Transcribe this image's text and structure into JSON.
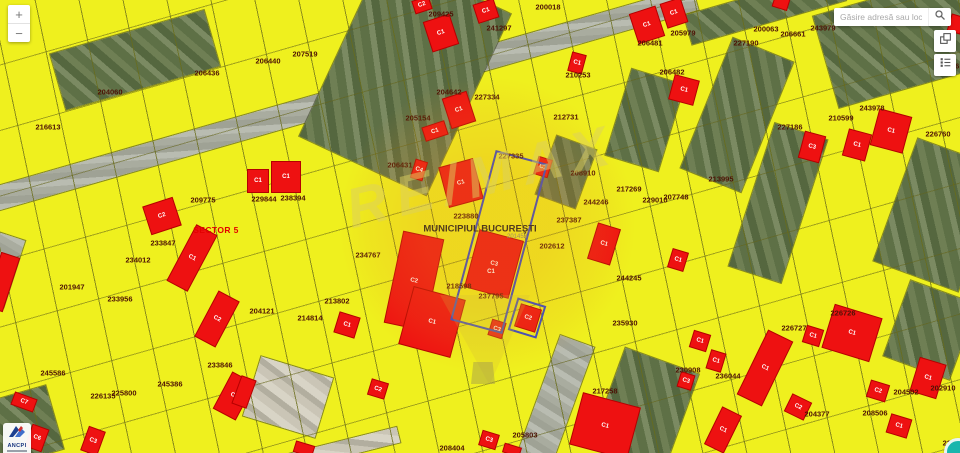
{
  "controls": {
    "zoom_in": "+",
    "zoom_out": "−",
    "search_placeholder": "Găsire adresă sau loc",
    "icons": {
      "search": "magnifier-icon",
      "basemap": "basemap-switch-icon",
      "legend": "legend-list-icon",
      "geolocate": "teal-circle-marker"
    }
  },
  "branding": {
    "watermark": "RE/MAX",
    "logo": "ANCPI"
  },
  "colors": {
    "parcel_fill": "#eff01e",
    "building_red": "#ee1111",
    "parcel_label": "#4d1205",
    "sector_red": "#e30000",
    "selection_blue": "#3346c8",
    "watermark_text": "rgba(219,208,95,0.5)",
    "geolocate_teal": "#19b6ad"
  },
  "map": {
    "municipality": "MUNICIPIUL BUCUREŞTI",
    "municipality_code": "201452",
    "sector": "SECTOR 5",
    "parcel_labels": [
      {
        "t": "216613",
        "x": 48,
        "y": 127
      },
      {
        "t": "204060",
        "x": 110,
        "y": 92
      },
      {
        "t": "206436",
        "x": 207,
        "y": 73
      },
      {
        "t": "206440",
        "x": 268,
        "y": 61
      },
      {
        "t": "207519",
        "x": 305,
        "y": 54
      },
      {
        "t": "209425",
        "x": 441,
        "y": 14
      },
      {
        "t": "200018",
        "x": 548,
        "y": 7
      },
      {
        "t": "241297",
        "x": 499,
        "y": 28
      },
      {
        "t": "204642",
        "x": 449,
        "y": 92
      },
      {
        "t": "205154",
        "x": 418,
        "y": 118
      },
      {
        "t": "227334",
        "x": 487,
        "y": 97
      },
      {
        "t": "210253",
        "x": 578,
        "y": 75
      },
      {
        "t": "212731",
        "x": 566,
        "y": 117
      },
      {
        "t": "227335",
        "x": 511,
        "y": 156
      },
      {
        "t": "206481",
        "x": 650,
        "y": 43
      },
      {
        "t": "205979",
        "x": 683,
        "y": 33
      },
      {
        "t": "206482",
        "x": 672,
        "y": 72
      },
      {
        "t": "200063",
        "x": 766,
        "y": 29
      },
      {
        "t": "206661",
        "x": 793,
        "y": 34
      },
      {
        "t": "243979",
        "x": 823,
        "y": 28
      },
      {
        "t": "227190",
        "x": 746,
        "y": 43
      },
      {
        "t": "243978",
        "x": 872,
        "y": 108
      },
      {
        "t": "210599",
        "x": 841,
        "y": 118
      },
      {
        "t": "227186",
        "x": 790,
        "y": 127
      },
      {
        "t": "226760",
        "x": 938,
        "y": 134
      },
      {
        "t": "209775",
        "x": 203,
        "y": 200
      },
      {
        "t": "229844",
        "x": 264,
        "y": 199
      },
      {
        "t": "238394",
        "x": 293,
        "y": 198
      },
      {
        "t": "206431",
        "x": 400,
        "y": 165
      },
      {
        "t": "208910",
        "x": 583,
        "y": 173
      },
      {
        "t": "213995",
        "x": 721,
        "y": 179
      },
      {
        "t": "217269",
        "x": 629,
        "y": 189
      },
      {
        "t": "229010",
        "x": 655,
        "y": 200
      },
      {
        "t": "207748",
        "x": 676,
        "y": 197
      },
      {
        "t": "244246",
        "x": 596,
        "y": 202
      },
      {
        "t": "223880",
        "x": 466,
        "y": 216
      },
      {
        "t": "237387",
        "x": 569,
        "y": 220
      },
      {
        "t": "202612",
        "x": 552,
        "y": 246
      },
      {
        "t": "244245",
        "x": 629,
        "y": 278
      },
      {
        "t": "233847",
        "x": 163,
        "y": 243
      },
      {
        "t": "234012",
        "x": 138,
        "y": 260
      },
      {
        "t": "201947",
        "x": 72,
        "y": 287
      },
      {
        "t": "233956",
        "x": 120,
        "y": 299
      },
      {
        "t": "234767",
        "x": 368,
        "y": 255
      },
      {
        "t": "218598",
        "x": 459,
        "y": 286
      },
      {
        "t": "237795",
        "x": 491,
        "y": 296
      },
      {
        "t": "213802",
        "x": 337,
        "y": 301
      },
      {
        "t": "204121",
        "x": 262,
        "y": 311
      },
      {
        "t": "214814",
        "x": 310,
        "y": 318
      },
      {
        "t": "235930",
        "x": 625,
        "y": 323
      },
      {
        "t": "233846",
        "x": 220,
        "y": 365
      },
      {
        "t": "245586",
        "x": 53,
        "y": 373
      },
      {
        "t": "245386",
        "x": 170,
        "y": 384
      },
      {
        "t": "226135",
        "x": 103,
        "y": 396
      },
      {
        "t": "225800",
        "x": 124,
        "y": 393
      },
      {
        "t": "226726",
        "x": 843,
        "y": 313
      },
      {
        "t": "226727",
        "x": 794,
        "y": 328
      },
      {
        "t": "236044",
        "x": 728,
        "y": 376
      },
      {
        "t": "230908",
        "x": 688,
        "y": 370
      },
      {
        "t": "217258",
        "x": 605,
        "y": 391
      },
      {
        "t": "205803",
        "x": 525,
        "y": 435
      },
      {
        "t": "208404",
        "x": 452,
        "y": 448
      },
      {
        "t": "204502",
        "x": 906,
        "y": 392
      },
      {
        "t": "202910",
        "x": 943,
        "y": 388
      },
      {
        "t": "208506",
        "x": 875,
        "y": 413
      },
      {
        "t": "204377",
        "x": 817,
        "y": 414
      },
      {
        "t": "2268",
        "x": 951,
        "y": 443
      },
      {
        "t": "206",
        "x": 953,
        "y": 66
      }
    ],
    "building_labels_extra": [
      {
        "t": "C1",
        "x": 491,
        "y": 272
      }
    ],
    "buildings": [
      {
        "t": "C2",
        "x": 422,
        "y": 5,
        "w": 16,
        "h": 12,
        "r": -18
      },
      {
        "t": "C1",
        "x": 441,
        "y": 33,
        "w": 26,
        "h": 30,
        "r": -18
      },
      {
        "t": "C1",
        "x": 459,
        "y": 110,
        "w": 24,
        "h": 30,
        "r": -18
      },
      {
        "t": "C1",
        "x": 435,
        "y": 131,
        "w": 22,
        "h": 13,
        "r": -18
      },
      {
        "t": "C1",
        "x": 486,
        "y": 11,
        "w": 20,
        "h": 18,
        "r": -18
      },
      {
        "t": "C1",
        "x": 647,
        "y": 25,
        "w": 26,
        "h": 30,
        "r": -18
      },
      {
        "t": "C1",
        "x": 674,
        "y": 13,
        "w": 20,
        "h": 24,
        "r": -18
      },
      {
        "t": "C1",
        "x": 577,
        "y": 63,
        "w": 13,
        "h": 18,
        "r": 15
      },
      {
        "t": "C1",
        "x": 684,
        "y": 90,
        "w": 24,
        "h": 24,
        "r": 15
      },
      {
        "t": "C3",
        "x": 812,
        "y": 147,
        "w": 20,
        "h": 26,
        "r": 15
      },
      {
        "t": "C1",
        "x": 857,
        "y": 145,
        "w": 22,
        "h": 26,
        "r": 15
      },
      {
        "t": "C1",
        "x": 891,
        "y": 131,
        "w": 32,
        "h": 36,
        "r": 15
      },
      {
        "t": "C1",
        "x": 258,
        "y": 181,
        "w": 20,
        "h": 22,
        "r": 0
      },
      {
        "t": "C1",
        "x": 286,
        "y": 177,
        "w": 28,
        "h": 30,
        "r": 0
      },
      {
        "t": "C2",
        "x": 162,
        "y": 216,
        "w": 30,
        "h": 28,
        "r": -18
      },
      {
        "t": "C1",
        "x": 192,
        "y": 258,
        "w": 22,
        "h": 62,
        "r": 28
      },
      {
        "t": "C2",
        "x": 217,
        "y": 319,
        "w": 22,
        "h": 50,
        "r": 28
      },
      {
        "t": "C4",
        "x": 419,
        "y": 170,
        "w": 11,
        "h": 18,
        "r": 17
      },
      {
        "t": "C1",
        "x": 461,
        "y": 183,
        "w": 34,
        "h": 40,
        "r": -15
      },
      {
        "t": "C1",
        "x": 543,
        "y": 167,
        "w": 13,
        "h": 17,
        "r": 17
      },
      {
        "t": "C1",
        "x": 604,
        "y": 244,
        "w": 22,
        "h": 36,
        "r": 17
      },
      {
        "t": "C1",
        "x": 678,
        "y": 260,
        "w": 15,
        "h": 18,
        "r": 17
      },
      {
        "t": "C2",
        "x": 414,
        "y": 281,
        "w": 40,
        "h": 92,
        "r": 12
      },
      {
        "t": "C3",
        "x": 494,
        "y": 264,
        "w": 44,
        "h": 58,
        "r": 15
      },
      {
        "t": "C1",
        "x": 347,
        "y": 325,
        "w": 20,
        "h": 20,
        "r": 17
      },
      {
        "t": "C1",
        "x": 432,
        "y": 322,
        "w": 52,
        "h": 58,
        "r": 15
      },
      {
        "t": "C2",
        "x": 378,
        "y": 389,
        "w": 16,
        "h": 15,
        "r": 17
      },
      {
        "t": "C3",
        "x": 497,
        "y": 329,
        "w": 13,
        "h": 15,
        "r": 17
      },
      {
        "t": "C2",
        "x": 528,
        "y": 318,
        "w": 20,
        "h": 22,
        "r": 17
      },
      {
        "t": "C1",
        "x": 700,
        "y": 341,
        "w": 16,
        "h": 16,
        "r": 17
      },
      {
        "t": "C3",
        "x": 686,
        "y": 381,
        "w": 13,
        "h": 14,
        "r": 17
      },
      {
        "t": "C1",
        "x": 716,
        "y": 361,
        "w": 14,
        "h": 18,
        "r": 17
      },
      {
        "t": "C1",
        "x": 765,
        "y": 368,
        "w": 26,
        "h": 70,
        "r": 26
      },
      {
        "t": "C2",
        "x": 798,
        "y": 407,
        "w": 20,
        "h": 18,
        "r": 26
      },
      {
        "t": "C1",
        "x": 813,
        "y": 336,
        "w": 16,
        "h": 16,
        "r": 17
      },
      {
        "t": "C1",
        "x": 852,
        "y": 333,
        "w": 48,
        "h": 44,
        "r": 17
      },
      {
        "t": "C2",
        "x": 878,
        "y": 391,
        "w": 18,
        "h": 16,
        "r": 17
      },
      {
        "t": "C1",
        "x": 899,
        "y": 426,
        "w": 20,
        "h": 18,
        "r": 17
      },
      {
        "t": "C1",
        "x": 928,
        "y": 378,
        "w": 26,
        "h": 34,
        "r": 17
      },
      {
        "t": "C1",
        "x": 723,
        "y": 430,
        "w": 20,
        "h": 40,
        "r": 26
      },
      {
        "t": "C1",
        "x": 605,
        "y": 426,
        "w": 58,
        "h": 52,
        "r": 15
      },
      {
        "t": "C3",
        "x": 489,
        "y": 440,
        "w": 16,
        "h": 14,
        "r": 17
      },
      {
        "t": "C1",
        "x": 234,
        "y": 396,
        "w": 24,
        "h": 40,
        "r": 28
      },
      {
        "t": "C3",
        "x": 93,
        "y": 441,
        "w": 16,
        "h": 24,
        "r": 20
      },
      {
        "t": "C6",
        "x": 37,
        "y": 438,
        "w": 16,
        "h": 22,
        "r": 20
      },
      {
        "t": "C7",
        "x": 24,
        "y": 402,
        "w": 22,
        "h": 12,
        "r": 20
      },
      {
        "t": "",
        "x": 2,
        "y": 282,
        "w": 18,
        "h": 55,
        "r": 18
      },
      {
        "t": "",
        "x": 244,
        "y": 392,
        "w": 14,
        "h": 28,
        "r": 20
      },
      {
        "t": "",
        "x": 781,
        "y": 3,
        "w": 14,
        "h": 10,
        "r": 17
      },
      {
        "t": "",
        "x": 304,
        "y": 449,
        "w": 18,
        "h": 10,
        "r": 17
      },
      {
        "t": "",
        "x": 512,
        "y": 450,
        "w": 16,
        "h": 8,
        "r": 17
      },
      {
        "t": "",
        "x": 956,
        "y": 24,
        "w": 12,
        "h": 16,
        "r": 17
      }
    ],
    "aerial_strips": [
      {
        "x": 330,
        "y": 103,
        "w": 760,
        "h": 24,
        "r": -16,
        "tone": "gray"
      },
      {
        "x": 405,
        "y": 75,
        "w": 140,
        "h": 200,
        "r": 25,
        "tone": "green"
      },
      {
        "x": 135,
        "y": 60,
        "w": 160,
        "h": 58,
        "r": -16,
        "tone": "green"
      },
      {
        "x": 903,
        "y": 40,
        "w": 160,
        "h": 95,
        "r": -16,
        "tone": "green"
      },
      {
        "x": 765,
        "y": 8,
        "w": 160,
        "h": 30,
        "r": -16,
        "tone": "green"
      },
      {
        "x": 737,
        "y": 115,
        "w": 65,
        "h": 140,
        "r": 22,
        "tone": "green"
      },
      {
        "x": 938,
        "y": 215,
        "w": 90,
        "h": 130,
        "r": 20,
        "tone": "green"
      },
      {
        "x": 566,
        "y": 172,
        "w": 42,
        "h": 62,
        "r": 20,
        "tone": "green"
      },
      {
        "x": 645,
        "y": 120,
        "w": 55,
        "h": 90,
        "r": 17,
        "tone": "green"
      },
      {
        "x": 778,
        "y": 203,
        "w": 55,
        "h": 150,
        "r": 18,
        "tone": "green"
      },
      {
        "x": 556,
        "y": 400,
        "w": 36,
        "h": 125,
        "r": 20,
        "tone": "gray"
      },
      {
        "x": 288,
        "y": 397,
        "w": 75,
        "h": 62,
        "r": 17,
        "tone": "light"
      },
      {
        "x": 345,
        "y": 448,
        "w": 110,
        "h": 16,
        "r": -14,
        "tone": "light"
      },
      {
        "x": 20,
        "y": 427,
        "w": 72,
        "h": 66,
        "r": -16,
        "tone": "green"
      },
      {
        "x": 930,
        "y": 330,
        "w": 70,
        "h": 80,
        "r": 20,
        "tone": "green"
      },
      {
        "x": 645,
        "y": 408,
        "w": 78,
        "h": 100,
        "r": 20,
        "tone": "green"
      },
      {
        "x": 2,
        "y": 270,
        "w": 26,
        "h": 70,
        "r": 18,
        "tone": "gray"
      }
    ],
    "selection_outlines": [
      {
        "x": 499,
        "y": 242,
        "w": 50,
        "h": 172,
        "r": 15
      },
      {
        "x": 527,
        "y": 318,
        "w": 26,
        "h": 30,
        "r": 17
      }
    ]
  }
}
